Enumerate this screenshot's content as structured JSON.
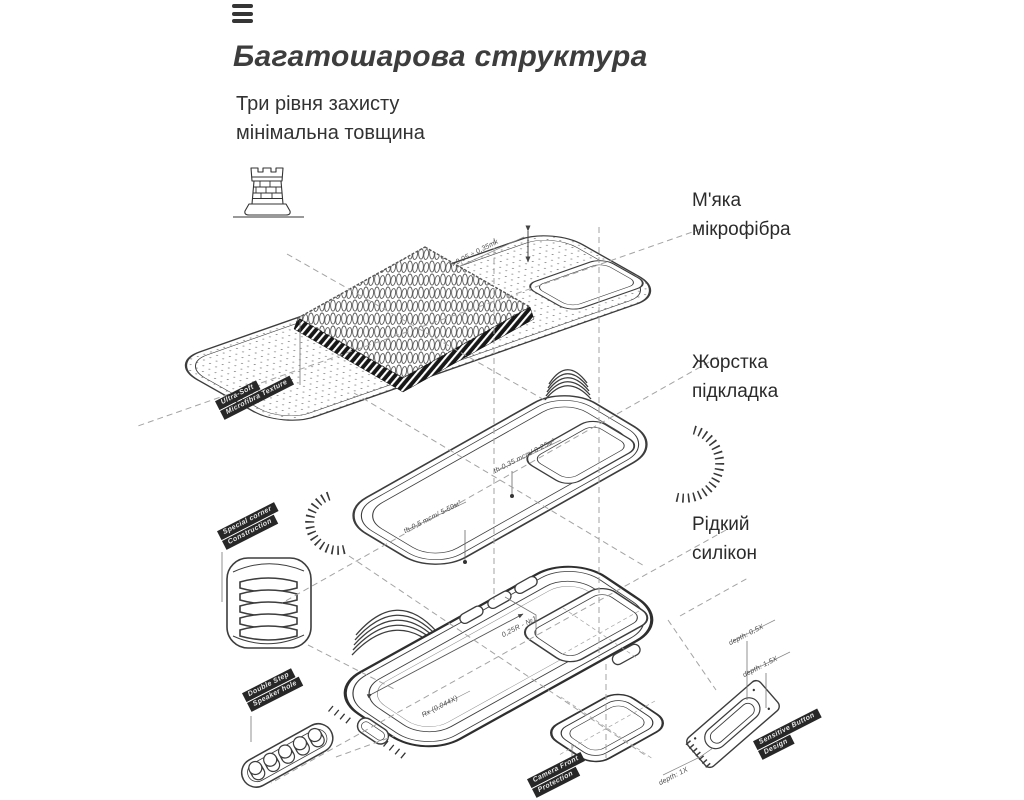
{
  "header": {
    "title": "Багатошарова структура",
    "subtitle_line1": "Три рівня захисту",
    "subtitle_line2": "мінімальна товщина"
  },
  "icons": {
    "menu": "hamburger-icon",
    "fortress": "castle-tower-icon"
  },
  "layer_labels": {
    "microfiber": {
      "line1": "М'яка",
      "line2": "мікрофібра"
    },
    "lining": {
      "line1": "Жорстка",
      "line2": "підкладка"
    },
    "silicone": {
      "line1": "Рідкий",
      "line2": "силікон"
    }
  },
  "ribbons": {
    "ultra_soft": {
      "line1": "Ultra-Soft",
      "line2": "Microfibra Texture"
    },
    "corner": {
      "line1": "Special corner",
      "line2": "Construction"
    },
    "speaker": {
      "line1": "Double Step",
      "line2": "Speaker hole"
    },
    "camera": {
      "line1": "Camera Front",
      "line2": "Protection"
    },
    "button": {
      "line1": "Sensitive Button",
      "line2": "Design"
    }
  },
  "annotations": {
    "microfiber_height": "h-0,05 ÷ 0,35mk",
    "lining_thickness_top": "th-0,35 mcm/ 0-25м²",
    "lining_thickness_bottom": "th-0,5 mcm/ 5-50м²",
    "button_radius": "0,25R - №1",
    "case_radius": "Rx (0,044X)",
    "depth_05": "depth: 0,5X",
    "depth_15": "depth: 1,5X",
    "depth_1": "depth: 1X"
  },
  "colors": {
    "line": "#3d3d3d",
    "dashed": "#a3a3a3",
    "label_bg": "#272727",
    "text": "#323232"
  }
}
